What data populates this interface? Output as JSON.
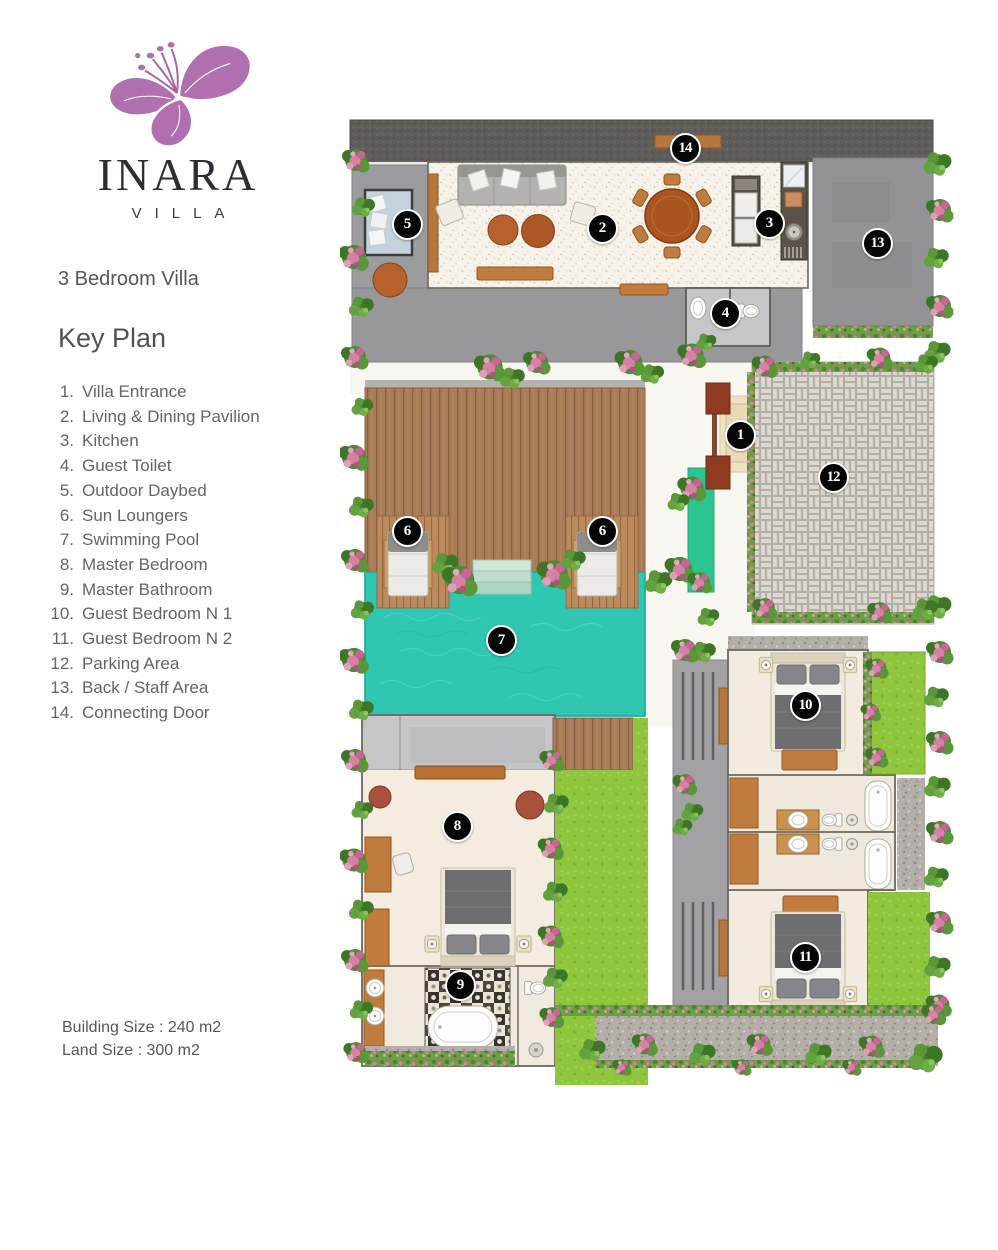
{
  "sidebar": {
    "brand": "INARA",
    "brand_sub": "VILLA",
    "subtitle": "3 Bedroom Villa",
    "key_plan_title": "Key Plan",
    "key_items": [
      {
        "num": "1.",
        "label": "Villa Entrance"
      },
      {
        "num": "2.",
        "label": "Living & Dining Pavilion"
      },
      {
        "num": "3.",
        "label": "Kitchen"
      },
      {
        "num": "4.",
        "label": "Guest Toilet"
      },
      {
        "num": "5.",
        "label": "Outdoor Daybed"
      },
      {
        "num": "6.",
        "label": "Sun Loungers"
      },
      {
        "num": "7.",
        "label": "Swimming Pool"
      },
      {
        "num": "8.",
        "label": "Master Bedroom"
      },
      {
        "num": "9.",
        "label": "Master Bathroom"
      },
      {
        "num": "10.",
        "label": "Guest Bedroom N 1"
      },
      {
        "num": "11.",
        "label": "Guest Bedroom N 2"
      },
      {
        "num": "12.",
        "label": "Parking Area"
      },
      {
        "num": "13.",
        "label": "Back / Staff Area"
      },
      {
        "num": "14.",
        "label": "Connecting Door"
      }
    ],
    "building_size": "Building Size : 240 m2",
    "land_size": "Land Size : 300 m2"
  },
  "plan": {
    "marker_color": "#050505",
    "colors": {
      "brand_purple": "#b06fae",
      "pool": "#2fc7b2",
      "lawn": "#90c63d",
      "deck": "#a87c57",
      "entrance_post": "#8f3b22"
    },
    "markers": [
      {
        "num": "1",
        "name": "villa-entrance",
        "x": 400,
        "y": 323
      },
      {
        "num": "2",
        "name": "living-dining-pavilion",
        "x": 262,
        "y": 116
      },
      {
        "num": "3",
        "name": "kitchen",
        "x": 429,
        "y": 111
      },
      {
        "num": "4",
        "name": "guest-toilet",
        "x": 385,
        "y": 201
      },
      {
        "num": "5",
        "name": "outdoor-daybed",
        "x": 67,
        "y": 112
      },
      {
        "num": "6",
        "name": "sun-lounger-left",
        "x": 67,
        "y": 419
      },
      {
        "num": "6",
        "name": "sun-lounger-right",
        "x": 262,
        "y": 419
      },
      {
        "num": "7",
        "name": "swimming-pool",
        "x": 161,
        "y": 528
      },
      {
        "num": "8",
        "name": "master-bedroom",
        "x": 117,
        "y": 714
      },
      {
        "num": "9",
        "name": "master-bathroom",
        "x": 120,
        "y": 873
      },
      {
        "num": "10",
        "name": "guest-bedroom-1",
        "x": 465,
        "y": 593
      },
      {
        "num": "11",
        "name": "guest-bedroom-2",
        "x": 465,
        "y": 845
      },
      {
        "num": "12",
        "name": "parking-area",
        "x": 493,
        "y": 365
      },
      {
        "num": "13",
        "name": "back-staff-area",
        "x": 537,
        "y": 131
      },
      {
        "num": "14",
        "name": "connecting-door",
        "x": 345,
        "y": 36
      }
    ]
  }
}
